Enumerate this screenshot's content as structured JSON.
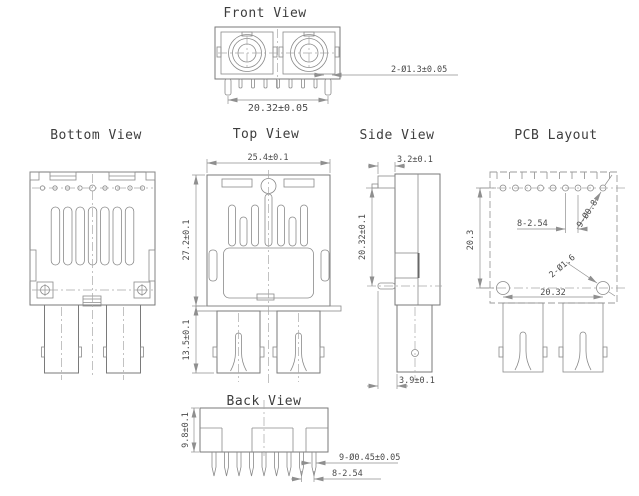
{
  "document": {
    "type": "connector-technical-drawing",
    "background": "#ffffff"
  },
  "colors": {
    "outline": "#7a7a7a",
    "outline_light": "#8a8a8a",
    "dimension": "#8f8f8f",
    "centerline": "#a8a8a8",
    "title_text": "#3d3d3d",
    "dim_text": "#4a4a4a",
    "background": "#ffffff"
  },
  "views": {
    "front": {
      "title": "Front View",
      "dim_pin_span": "20.32±0.05",
      "dim_pin_dia": "2-Ø1.3±0.05"
    },
    "bottom": {
      "title": "Bottom View"
    },
    "top": {
      "title": "Top View",
      "dim_width": "25.4±0.1",
      "dim_body_height": "27.2±0.1",
      "dim_leg_height": "13.5±0.1"
    },
    "side": {
      "title": "Side View",
      "dim_flange": "3.2±0.1",
      "dim_height": "20.32±0.1",
      "dim_leg_offset": "3.9±0.1"
    },
    "pcb": {
      "title": "PCB Layout",
      "dim_row_gap": "20.3",
      "dim_pitch": "8-2.54",
      "dim_small_holes": "9-Ø0.8",
      "dim_big_holes": "2-Ø1.6",
      "dim_span": "20.32"
    },
    "back": {
      "title": "Back View",
      "dim_height": "9.8±0.1",
      "dim_pin_dia": "9-Ø0.45±0.05",
      "dim_pitch": "8-2.54"
    }
  }
}
